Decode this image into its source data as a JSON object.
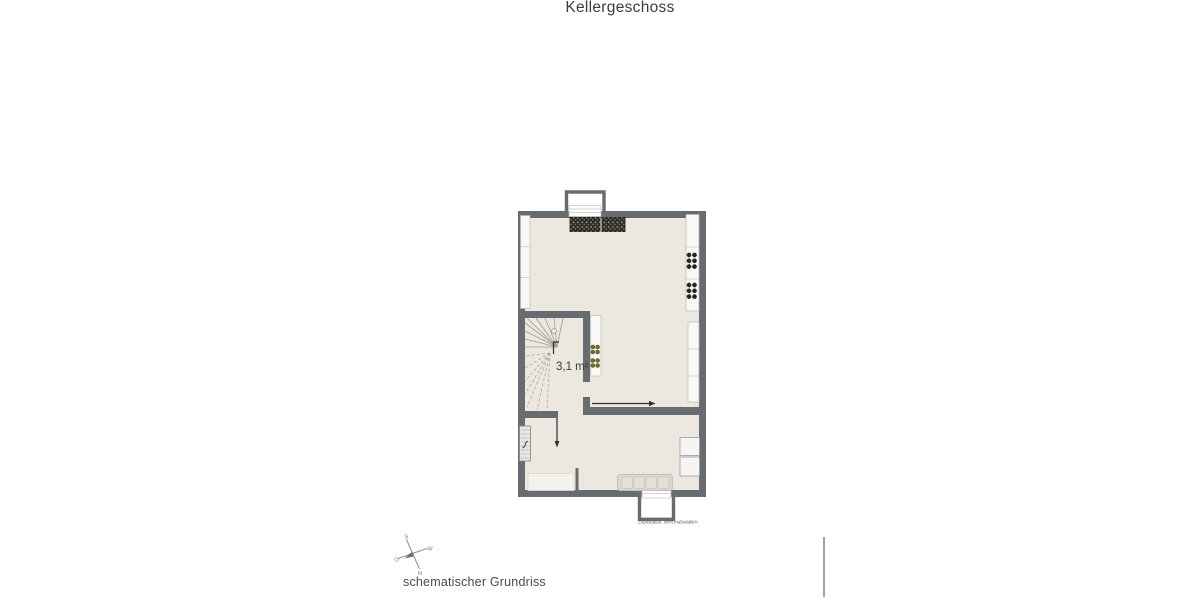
{
  "page": {
    "title": "Kellergeschoss",
    "caption": "schematischer Grundriss"
  },
  "floor_plan": {
    "area_label": "3,1 m²",
    "disclaimer": "Exposéplan, nicht maßstäblich"
  },
  "compass": {
    "north": "N",
    "south": "S",
    "east": "O",
    "west": "W"
  },
  "colors": {
    "wall": "#686b70",
    "floor": "#ece8e0",
    "background": "#ffffff",
    "rack_dark": "#2b2a24",
    "plant_green": "#6d6f2e"
  }
}
